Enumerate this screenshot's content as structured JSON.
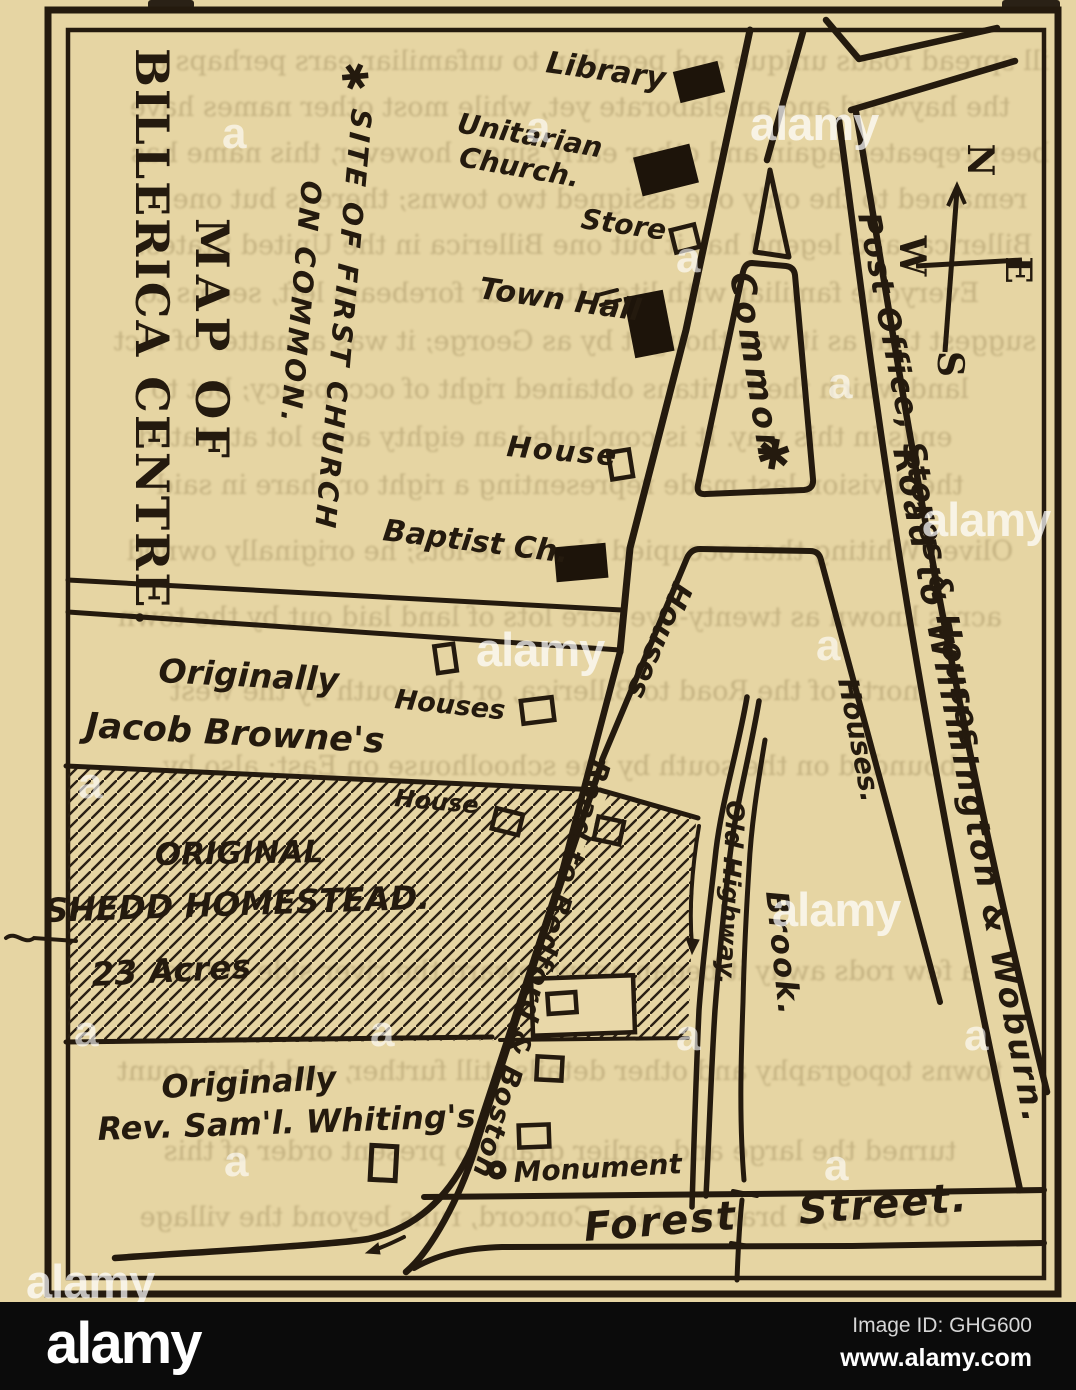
{
  "scan": {
    "page_color": "#e9d8a9",
    "ink_color": "#241a0e",
    "ghost_lines": [
      "ill spread roads unique and peculiar, to unfamiliar ears perhaps a",
      "the hayward and an elaborate yet, while most other names have",
      "been repeated again and other early since, however, this name has",
      "remained to the only one assigned two towns; there is but one",
      "Billerica, and legend has it but one Billerica in the United States.",
      "Everyone familiar with literature our forebears left, seems to",
      "suggest that as it was thought by as George; it was a matter of fact",
      "land which the Puritans obtained right of occupancy; but to",
      "ends in this way. It is concluded an eighty acre lot at stated",
      "the division last made representing a right or share in said",
      "Oliver Whiting then occupied his house-lots; he originally owned",
      "acres known as twenty-five acre lots of land laid out by the town",
      "north of the Road to Billerica, or the south by the west",
      "bounded on the south by the schoolhouse on East; also by",
      "a few rods away it began anew toward the river side of this",
      "towns topography and other details still further, and there count",
      "turned the large and earlier grant to present order of this",
      "of Forest, a branch of the Concord, runs beyond the village"
    ]
  },
  "map": {
    "title_line1": "MAP OF",
    "title_line2": "BILLERICA CENTRE.",
    "site_marker": "✱",
    "site_note_line1": "SITE OF FIRST CHURCH",
    "site_note_line2": "ON COMMON.",
    "compass": {
      "n": "N",
      "e": "E",
      "w": "W",
      "s": "S"
    },
    "labels": {
      "library": "Library",
      "unitarian_1": "Unitarian",
      "unitarian_2": "Church.",
      "store": "Store",
      "town_hall": "Town Hall",
      "house_main": "House",
      "baptist": "Baptist Ch.",
      "common": "Common",
      "post_office": "Post Office, Stores & Houses",
      "willimington": "Road to Willimington & Woburn.",
      "houses_road": "Houses.",
      "houses_lot": "Houses",
      "houses_browne": "Houses",
      "house_hatch": "House",
      "browne_1": "Originally",
      "browne_2": "Jacob Browne's",
      "shedd_1": "ORIGINAL",
      "shedd_2": "SHEDD HOMESTEAD.",
      "shedd_3": "23 Acres",
      "whiting_1": "Originally",
      "whiting_2": "Rev. Sam'l. Whiting's.",
      "bedford": "Road to Bedford & Boston",
      "old_highway": "Old Highway.",
      "brook": "Brook.",
      "monument": "Monument",
      "forest": "Forest Street."
    }
  },
  "watermark": {
    "word": "alamy",
    "tile": "a"
  },
  "footer": {
    "brand": "alamy",
    "image_id": "Image ID: GHG600",
    "url": "www.alamy.com"
  }
}
